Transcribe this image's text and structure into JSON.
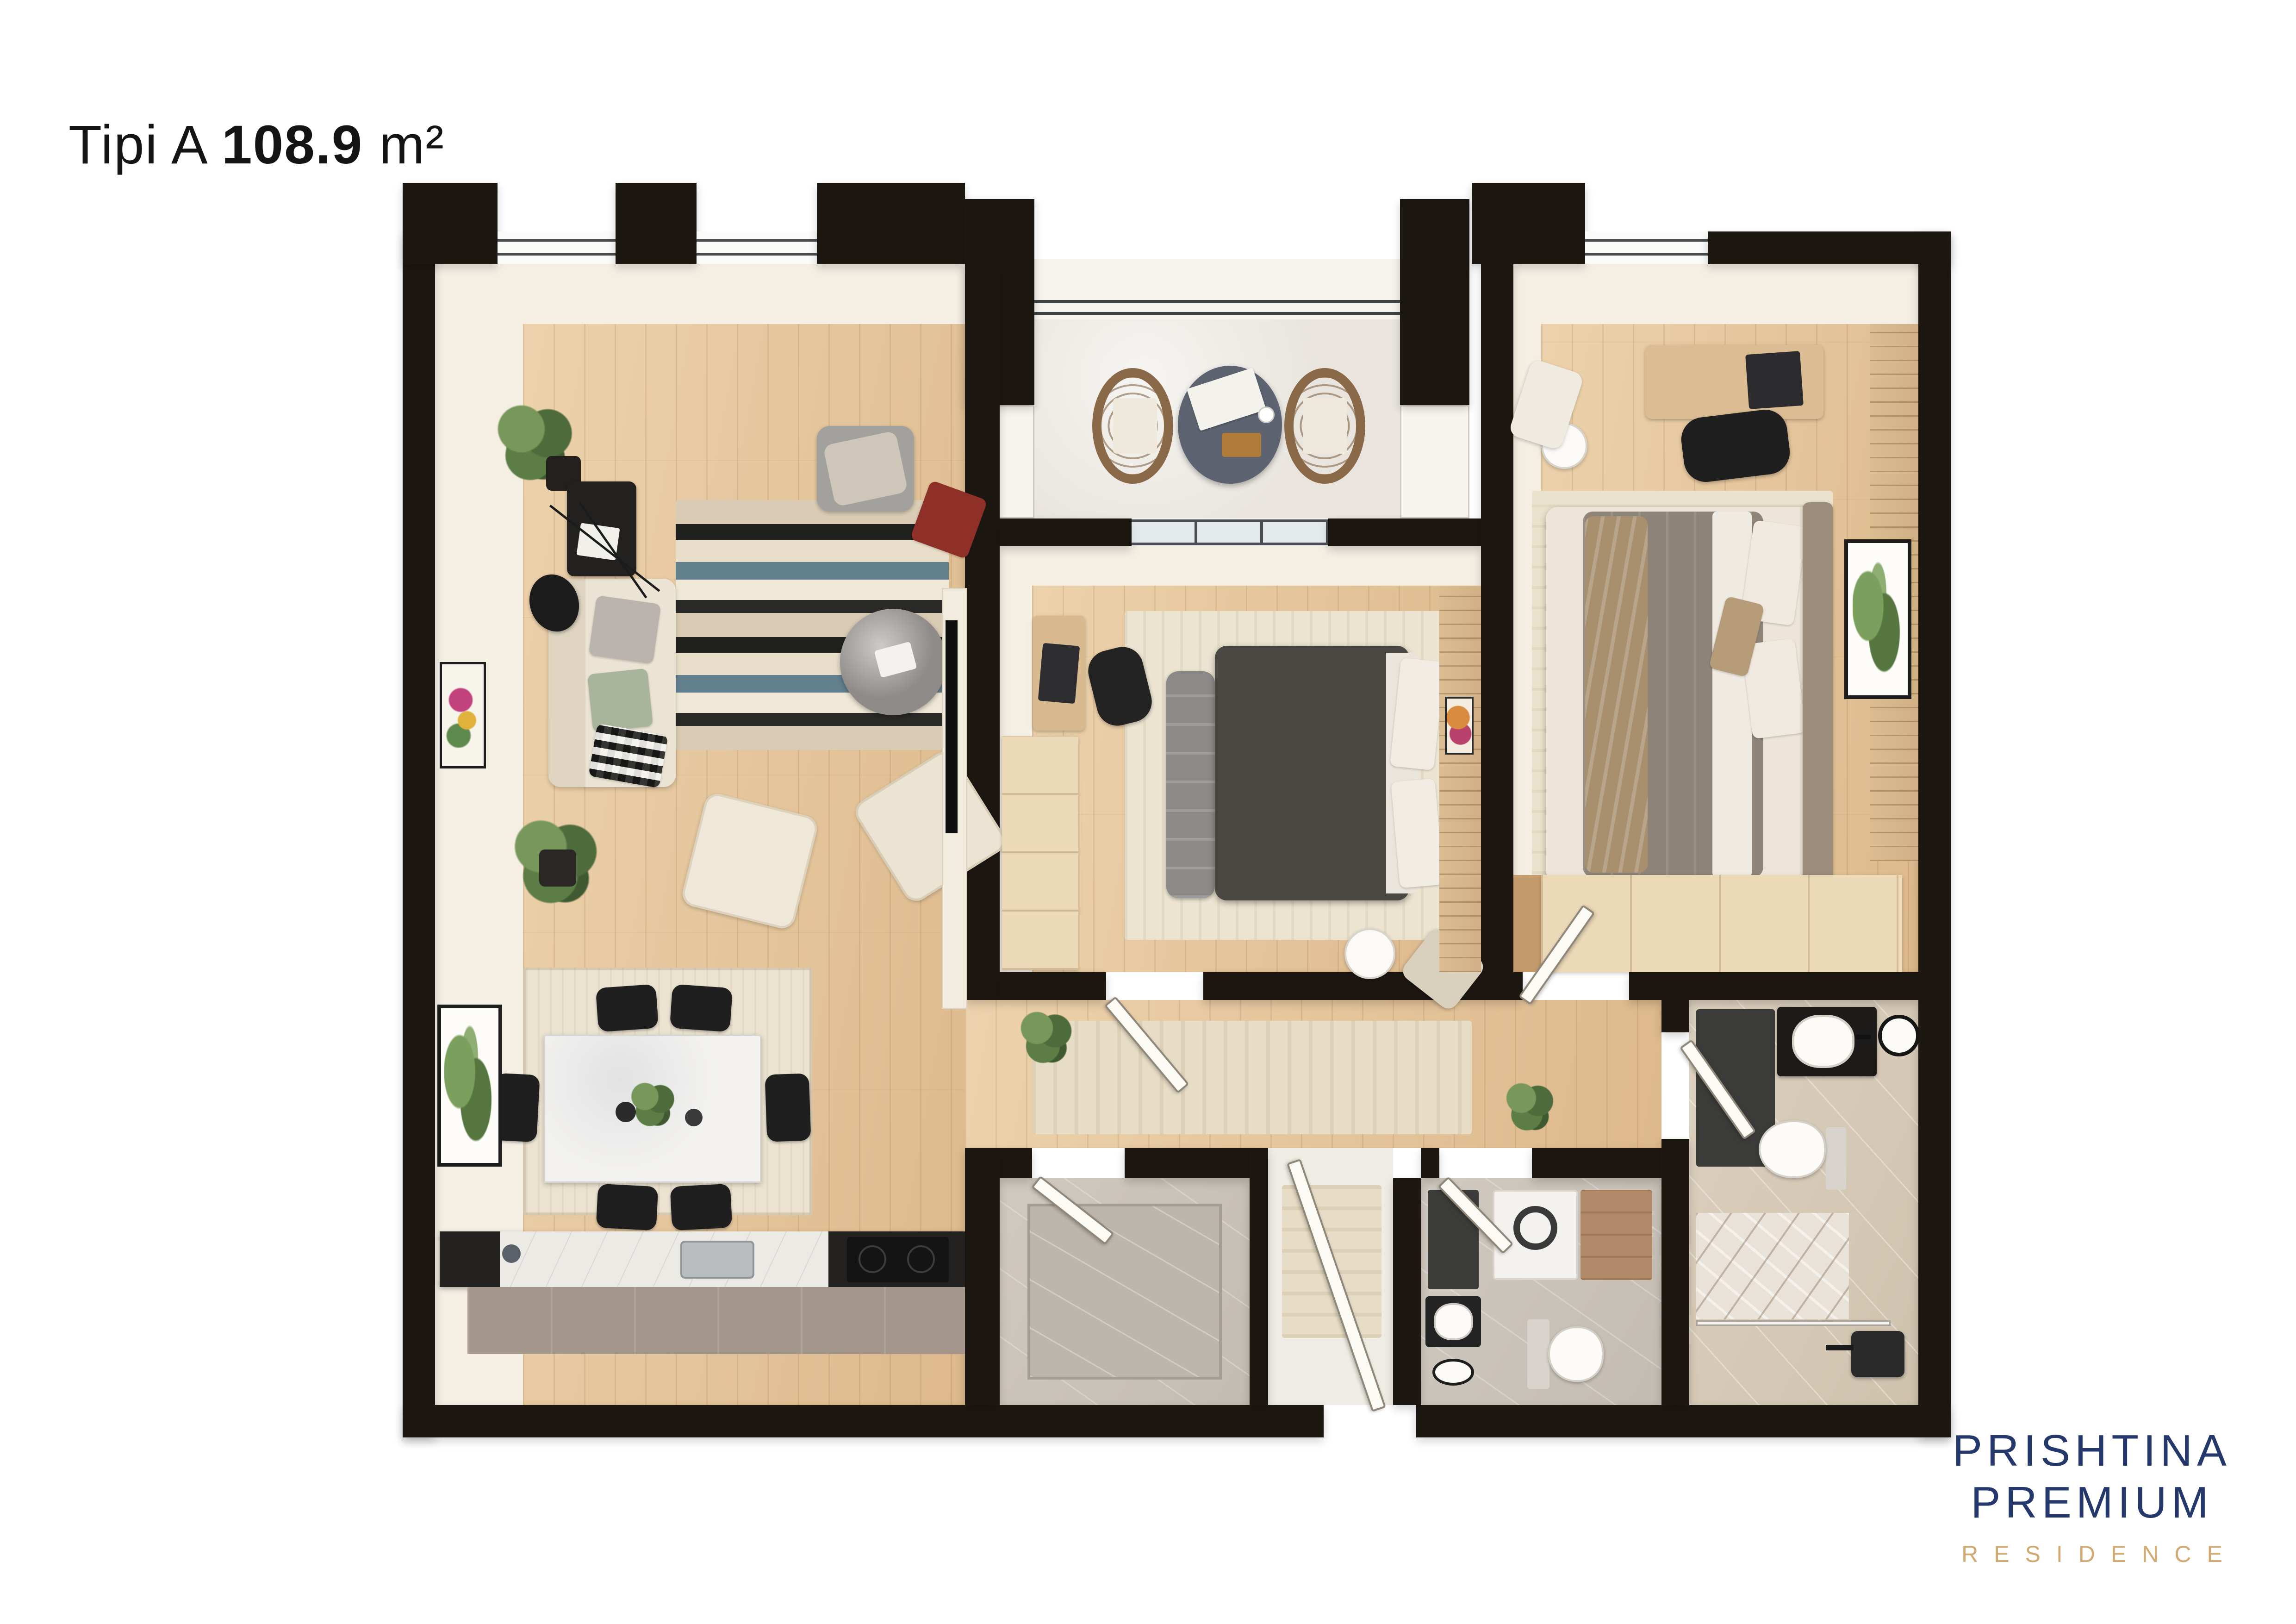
{
  "title": {
    "prefix": "Tipi A",
    "area": "108.9",
    "unit": "m²"
  },
  "logo": {
    "line1": "PRISHTINA",
    "line2": "PREMIUM",
    "tagline": "RESIDENCE",
    "primary_color": "#24386b",
    "accent_color": "#d2a970"
  },
  "plan": {
    "wall_color": "#1d1712",
    "wood_floor_color": "#e4c49c",
    "rooms": [
      {
        "name": "living-dining-kitchen"
      },
      {
        "name": "balcony"
      },
      {
        "name": "bedroom-1"
      },
      {
        "name": "bedroom-2"
      },
      {
        "name": "hallway"
      },
      {
        "name": "entry-corridor"
      },
      {
        "name": "pantry"
      },
      {
        "name": "wc-laundry"
      },
      {
        "name": "bathroom"
      }
    ]
  }
}
